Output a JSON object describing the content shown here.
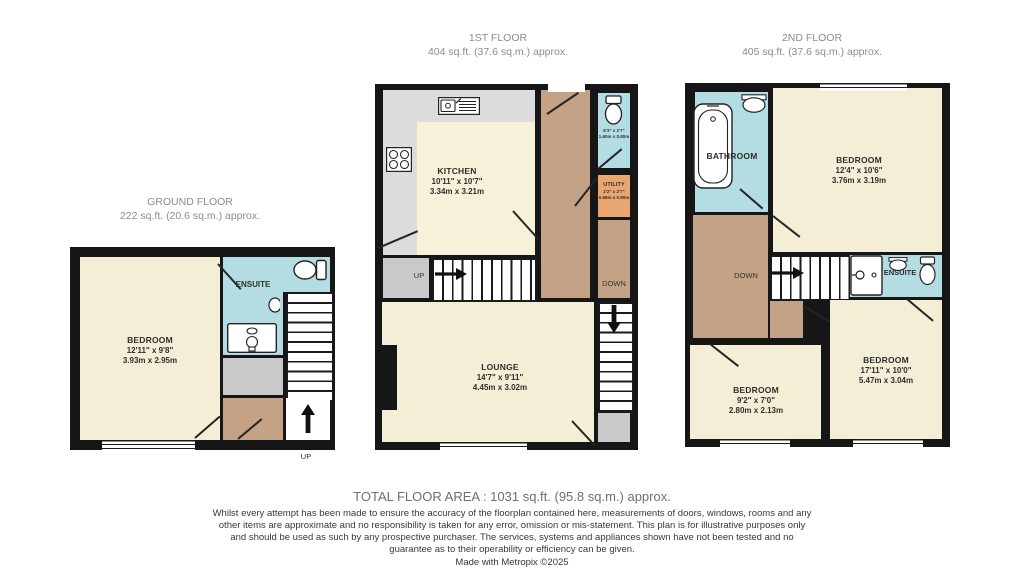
{
  "floors": {
    "ground": {
      "title": "GROUND FLOOR",
      "area": "222 sq.ft. (20.6 sq.m.) approx."
    },
    "first": {
      "title": "1ST FLOOR",
      "area": "404 sq.ft. (37.6 sq.m.) approx."
    },
    "second": {
      "title": "2ND FLOOR",
      "area": "405 sq.ft. (37.6 sq.m.) approx."
    }
  },
  "rooms": {
    "gf_bedroom": {
      "name": "BEDROOM",
      "imperial": "12'11\" x 9'8\"",
      "metric": "3.93m x 2.95m"
    },
    "gf_ensuite": {
      "name": "ENSUITE"
    },
    "ff_kitchen": {
      "name": "KITCHEN",
      "imperial": "10'11\" x 10'7\"",
      "metric": "3.34m x 3.21m"
    },
    "ff_wc": {
      "imperial": "5'3\" x 2'7\"",
      "metric": "1.60m x 0.80m"
    },
    "ff_utility": {
      "name": "UTILITY",
      "imperial": "2'2\" x 2'7\"",
      "metric": "0.66m x 0.80m"
    },
    "ff_lounge": {
      "name": "LOUNGE",
      "imperial": "14'7\" x 9'11\"",
      "metric": "4.45m x 3.02m"
    },
    "sf_bathroom": {
      "name": "BATHROOM"
    },
    "sf_bedroom_top": {
      "name": "BEDROOM",
      "imperial": "12'4\" x 10'6\"",
      "metric": "3.76m x 3.19m"
    },
    "sf_ensuite": {
      "name": "ENSUITE"
    },
    "sf_bedroom_small": {
      "name": "BEDROOM",
      "imperial": "9'2\" x 7'0\"",
      "metric": "2.80m x 2.13m"
    },
    "sf_bedroom_large": {
      "name": "BEDROOM",
      "imperial": "17'11\" x 10'0\"",
      "metric": "5.47m x 3.04m"
    }
  },
  "stairs": {
    "up": "UP",
    "down": "DOWN"
  },
  "footer": {
    "total": "TOTAL FLOOR AREA : 1031 sq.ft. (95.8 sq.m.) approx.",
    "disclaimer": "Whilst every attempt has been made to ensure the accuracy of the floorplan contained here, measurements of doors, windows, rooms and any other items are approximate and no responsibility is taken for any error, omission or mis-statement. This plan is for illustrative purposes only and should be used as such by any prospective purchaser. The services, systems and appliances shown have not been tested and no guarantee as to their operability or efficiency can be given.",
    "credit": "Made with Metropix ©2025"
  },
  "colors": {
    "wall": "#161616",
    "cream": "#f5eed6",
    "blue": "#b3dce3",
    "tan": "#c3a285",
    "orange": "#eaa671",
    "gray": "#c9c9c9",
    "kitchen_gray": "#dcdcdc"
  }
}
